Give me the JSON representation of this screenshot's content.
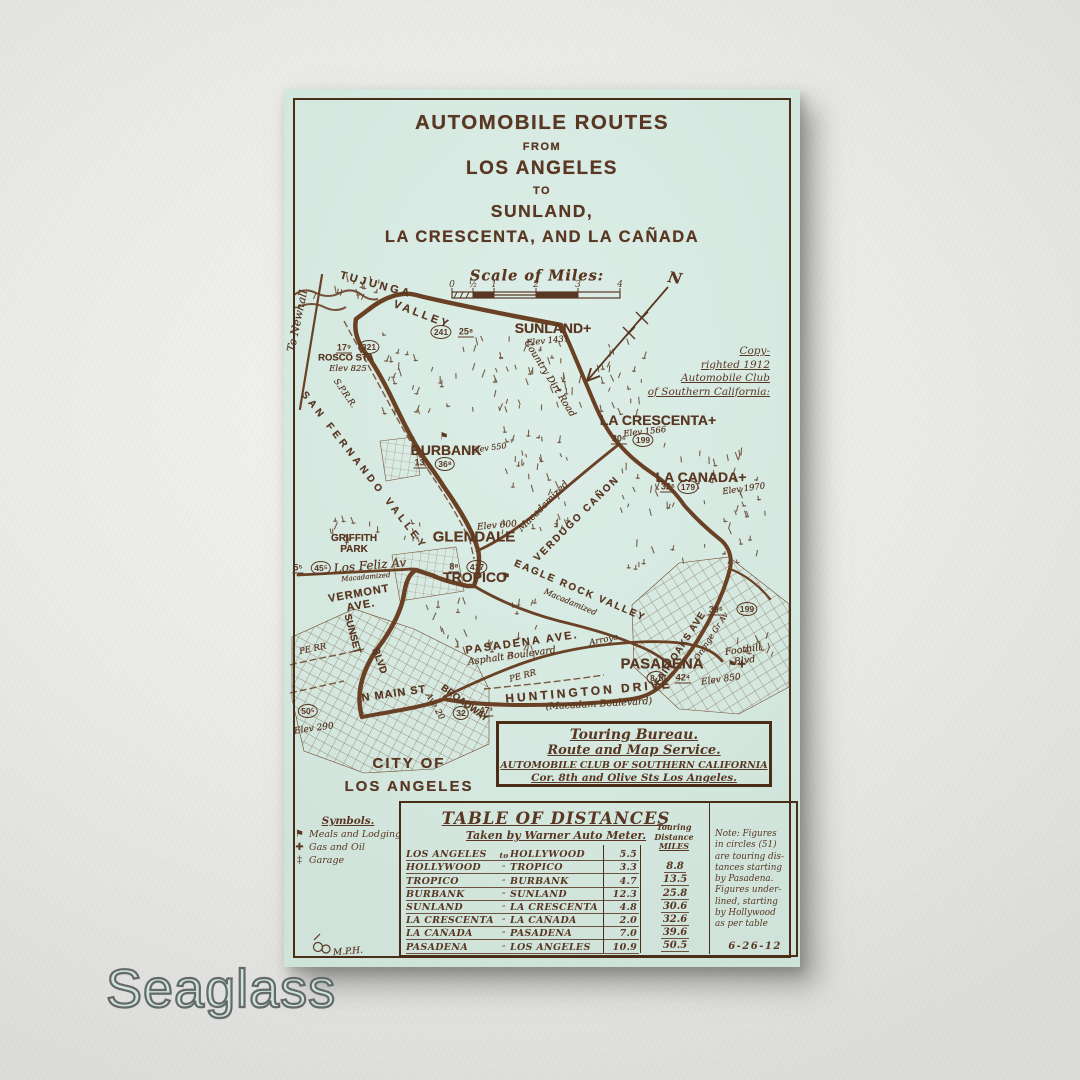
{
  "watermark": {
    "text": "Seaglass"
  },
  "colors": {
    "wall": "#e9e9e7",
    "panel": "#d6eae2",
    "ink": "#593722",
    "frame": "#4a2d17",
    "watermark_fill": "#cfe4dc"
  },
  "map": {
    "title": {
      "lines": [
        "AUTOMOBILE ROUTES",
        "FROM",
        "LOS ANGELES",
        "TO",
        "SUNLAND,",
        "LA CRESCENTA, AND LA CAÑADA"
      ]
    },
    "scale": {
      "label": "Scale of Miles:",
      "ticks": [
        "0",
        "½",
        "1",
        "2",
        "3",
        "4"
      ]
    },
    "north": {
      "label": "N"
    },
    "copyright": {
      "lines": [
        "Copy-",
        "righted 1912",
        "Automobile Club",
        "of Southern California:"
      ]
    },
    "labels": [
      {
        "n": "to-newhall",
        "t": "To Newhall",
        "x": 14,
        "y": 232,
        "r": -78,
        "c": "script",
        "fs": 11
      },
      {
        "n": "tujunga",
        "t": "TUJUNGA",
        "x": 92,
        "y": 196,
        "r": 15,
        "c": "stencil",
        "fs": 11,
        "ls": 3
      },
      {
        "n": "tujunga-valley",
        "t": "VALLEY",
        "x": 138,
        "y": 226,
        "r": 21,
        "c": "stencil",
        "fs": 11,
        "ls": 3
      },
      {
        "n": "rosco-sta",
        "t": "ROSCO STA",
        "x": 62,
        "y": 270,
        "r": 0,
        "c": "stencil",
        "fs": 9.5
      },
      {
        "n": "rosco-elev",
        "t": "Elev 825",
        "x": 64,
        "y": 281,
        "r": 0,
        "c": "script",
        "fs": 8.5
      },
      {
        "n": "sunland",
        "t": "SUNLAND+",
        "x": 269,
        "y": 240,
        "r": 0,
        "c": "stencil",
        "fs": 14
      },
      {
        "n": "sunland-elev",
        "t": "Elev 1431",
        "x": 264,
        "y": 253,
        "r": -6,
        "c": "script",
        "fs": 8.5
      },
      {
        "n": "country-dirt-road",
        "t": "Country Dirt Road",
        "x": 265,
        "y": 290,
        "r": 58,
        "c": "script",
        "fs": 9.5
      },
      {
        "n": "la-crescenta",
        "t": "LA CRESCENTA+",
        "x": 374,
        "y": 332,
        "r": 0,
        "c": "stencil",
        "fs": 14
      },
      {
        "n": "la-crescenta-elev",
        "t": "Elev 1566",
        "x": 361,
        "y": 344,
        "r": -6,
        "c": "script",
        "fs": 8.5
      },
      {
        "n": "la-canada",
        "t": "LA CANADA+",
        "x": 417,
        "y": 389,
        "r": 0,
        "c": "stencil",
        "fs": 14
      },
      {
        "n": "la-canada-elev",
        "t": "Elev 1970",
        "x": 460,
        "y": 401,
        "r": -8,
        "c": "script",
        "fs": 8.5
      },
      {
        "n": "sprr",
        "t": "S.P.R.R.",
        "x": 60,
        "y": 305,
        "r": 55,
        "c": "script",
        "fs": 8.5
      },
      {
        "n": "san-fernando-valley",
        "t": "SAN FERNANDO VALLEY",
        "x": 80,
        "y": 382,
        "r": 52,
        "c": "stencil",
        "fs": 10,
        "ls": 4
      },
      {
        "n": "burbank",
        "t": "BURBANK",
        "x": 162,
        "y": 362,
        "r": 0,
        "c": "stencil",
        "fs": 14
      },
      {
        "n": "burbank-elev",
        "t": "Elev 550",
        "x": 205,
        "y": 360,
        "r": -8,
        "c": "script",
        "fs": 8
      },
      {
        "n": "glendale-elev",
        "t": "Elev 600",
        "x": 213,
        "y": 437,
        "r": -5,
        "c": "script",
        "fs": 9
      },
      {
        "n": "glendale",
        "t": "GLENDALE",
        "x": 190,
        "y": 449,
        "r": 0,
        "c": "stencil",
        "fs": 15
      },
      {
        "n": "macadamized-verdugo",
        "t": "Macadamized",
        "x": 260,
        "y": 418,
        "r": -45,
        "c": "script",
        "fs": 9.5
      },
      {
        "n": "verdugo-canon",
        "t": "VERDUGO CAÑON",
        "x": 293,
        "y": 430,
        "r": -45,
        "c": "stencil",
        "fs": 10,
        "ls": 2
      },
      {
        "n": "griffith-park",
        "t": "GRIFFITH\nPARK",
        "x": 70,
        "y": 455,
        "r": 0,
        "c": "stencil",
        "fs": 10
      },
      {
        "n": "los-feliz-av",
        "t": "Los Feliz Av",
        "x": 86,
        "y": 477,
        "r": -5,
        "c": "script",
        "fs": 12
      },
      {
        "n": "macadamized-losfeliz",
        "t": "Macadamized",
        "x": 82,
        "y": 489,
        "r": -5,
        "c": "script",
        "fs": 7
      },
      {
        "n": "vermont-ave",
        "t": "VERMONT\nAVE.",
        "x": 76,
        "y": 511,
        "r": -10,
        "c": "stencil",
        "fs": 11,
        "ls": 1
      },
      {
        "n": "tropico",
        "t": "TROPICO",
        "x": 191,
        "y": 489,
        "r": 0,
        "c": "stencil",
        "fs": 14
      },
      {
        "n": "sunset",
        "t": "SUNSET",
        "x": 68,
        "y": 545,
        "r": 75,
        "c": "stencil",
        "fs": 10
      },
      {
        "n": "sunset-blvd",
        "t": "BLVD",
        "x": 95,
        "y": 572,
        "r": 70,
        "c": "stencil",
        "fs": 10
      },
      {
        "n": "pe-rr-west",
        "t": "PE RR",
        "x": 29,
        "y": 561,
        "r": -12,
        "c": "script",
        "fs": 8.5
      },
      {
        "n": "eagle-rock-valley",
        "t": "EAGLE ROCK VALLEY",
        "x": 296,
        "y": 502,
        "r": 23,
        "c": "stencil",
        "fs": 10,
        "ls": 2
      },
      {
        "n": "macadamized-eagle",
        "t": "Macadamized",
        "x": 286,
        "y": 514,
        "r": 23,
        "c": "script",
        "fs": 8
      },
      {
        "n": "pasadena-ave",
        "t": "PASADENA AVE.",
        "x": 238,
        "y": 554,
        "r": -8,
        "c": "stencil",
        "fs": 11,
        "ls": 2
      },
      {
        "n": "asphalt-boulevard",
        "t": "Asphalt Boulevard",
        "x": 228,
        "y": 568,
        "r": -8,
        "c": "script",
        "fs": 9.5
      },
      {
        "n": "arroyo",
        "t": "Arroyo",
        "x": 320,
        "y": 552,
        "r": -12,
        "c": "script",
        "fs": 8.5
      },
      {
        "n": "pe-rr-east",
        "t": "PE RR",
        "x": 239,
        "y": 588,
        "r": -15,
        "c": "script",
        "fs": 8.5
      },
      {
        "n": "fair-oaks-ave",
        "t": "FAIR OAKS AVE",
        "x": 397,
        "y": 560,
        "r": -57,
        "c": "stencil",
        "fs": 9.5,
        "ls": 1
      },
      {
        "n": "orange-grove-av",
        "t": "Orange Gr Av",
        "x": 428,
        "y": 548,
        "r": -57,
        "c": "script",
        "fs": 8
      },
      {
        "n": "foothill-blvd",
        "t": "Foothill\nBlvd",
        "x": 460,
        "y": 567,
        "r": -8,
        "c": "script",
        "fs": 9.5
      },
      {
        "n": "pasadena",
        "t": "PASADENA",
        "x": 378,
        "y": 576,
        "r": 0,
        "c": "stencil",
        "fs": 15
      },
      {
        "n": "pasadena-elev",
        "t": "Elev 850",
        "x": 437,
        "y": 591,
        "r": -8,
        "c": "script",
        "fs": 9
      },
      {
        "n": "huntington-drive",
        "t": "HUNTINGTON DRIVE",
        "x": 305,
        "y": 603,
        "r": -5,
        "c": "stencil",
        "fs": 12,
        "ls": 3
      },
      {
        "n": "macadam-boulevard",
        "t": "(Macadam Boulevard)",
        "x": 315,
        "y": 616,
        "r": -3,
        "c": "script",
        "fs": 9.5
      },
      {
        "n": "n-main-st",
        "t": "N MAIN ST",
        "x": 110,
        "y": 605,
        "r": -8,
        "c": "stencil",
        "fs": 11,
        "ls": 1
      },
      {
        "n": "broadway",
        "t": "BROADWAY",
        "x": 180,
        "y": 615,
        "r": 36,
        "c": "stencil",
        "fs": 9.5
      },
      {
        "n": "ave-20",
        "t": "Ave 20",
        "x": 150,
        "y": 618,
        "r": 60,
        "c": "script",
        "fs": 8.5
      },
      {
        "n": "la-elev",
        "t": "Elev 290",
        "x": 30,
        "y": 640,
        "r": -8,
        "c": "script",
        "fs": 9
      },
      {
        "n": "city-of-los-angeles",
        "t": "CITY OF\nLOS ANGELES",
        "x": 125,
        "y": 686,
        "r": 0,
        "c": "stencil",
        "fs": 15,
        "ls": 2,
        "lh": 1.55
      },
      {
        "n": "mph-initials",
        "t": "M.P.H.",
        "x": 64,
        "y": 863,
        "r": -5,
        "c": "script",
        "fs": 9
      }
    ],
    "badges": [
      {
        "k": "u",
        "t": "17⁹",
        "x": 60,
        "y": 259
      },
      {
        "k": "c",
        "t": "321",
        "x": 85,
        "y": 258
      },
      {
        "k": "c",
        "t": "241",
        "x": 157,
        "y": 243
      },
      {
        "k": "u",
        "t": "25⁸",
        "x": 182,
        "y": 243
      },
      {
        "k": "u",
        "t": "30⁶",
        "x": 335,
        "y": 350
      },
      {
        "k": "c",
        "t": "199",
        "x": 359,
        "y": 351
      },
      {
        "k": "u",
        "t": "32⁶",
        "x": 384,
        "y": 398
      },
      {
        "k": "c",
        "t": "179",
        "x": 404,
        "y": 398
      },
      {
        "k": "u",
        "t": "13²",
        "x": 137,
        "y": 374
      },
      {
        "k": "c",
        "t": "36⁸",
        "x": 161,
        "y": 375
      },
      {
        "k": "u",
        "t": "8⁸",
        "x": 170,
        "y": 478
      },
      {
        "k": "c",
        "t": "417",
        "x": 193,
        "y": 478
      },
      {
        "k": "u",
        "t": "5⁵",
        "x": 14,
        "y": 479
      },
      {
        "k": "c",
        "t": "45⁵",
        "x": 37,
        "y": 479
      },
      {
        "k": "u",
        "t": "39⁶",
        "x": 432,
        "y": 521
      },
      {
        "k": "c",
        "t": "199",
        "x": 463,
        "y": 520
      },
      {
        "k": "c",
        "t": "8.1",
        "x": 372,
        "y": 589
      },
      {
        "k": "u",
        "t": "42⁴",
        "x": 399,
        "y": 589
      },
      {
        "k": "c",
        "t": "50⁵",
        "x": 24,
        "y": 622
      },
      {
        "k": "c",
        "t": "32",
        "x": 177,
        "y": 624
      },
      {
        "k": "u",
        "t": "47³",
        "x": 202,
        "y": 622
      }
    ],
    "icons": [
      {
        "type": "flag",
        "x": 160,
        "y": 348
      },
      {
        "type": "flag",
        "x": 222,
        "y": 488
      },
      {
        "type": "flag",
        "x": 448,
        "y": 576
      },
      {
        "type": "gas-cross",
        "x": 458,
        "y": 576
      }
    ],
    "symbols": {
      "title": "Symbols.",
      "items": [
        {
          "icon": "flag",
          "label": "Meals and Lodging"
        },
        {
          "icon": "gas-cross",
          "label": "Gas and Oil"
        },
        {
          "icon": "garage-cross",
          "label": "Garage"
        }
      ]
    },
    "touring_bureau": {
      "lines": [
        "Touring Bureau.",
        "Route and Map Service.",
        "AUTOMOBILE CLUB OF SOUTHERN CALIFORNIA",
        "Cor. 8th and Olive Sts Los Angeles."
      ]
    },
    "distance_table": {
      "title": "TABLE OF DISTANCES",
      "subtitle": "Taken by Warner Auto Meter.",
      "touring_header": [
        "Touring",
        "Distance",
        "MILES"
      ],
      "rows": [
        {
          "from": "LOS ANGELES",
          "sep": "to",
          "to": "HOLLYWOOD",
          "miles": "5.5",
          "touring": ""
        },
        {
          "from": "HOLLYWOOD",
          "sep": "″",
          "to": "TROPICO",
          "miles": "3.3",
          "touring": "8.8"
        },
        {
          "from": "TROPICO",
          "sep": "″",
          "to": "BURBANK",
          "miles": "4.7",
          "touring": "13.5"
        },
        {
          "from": "BURBANK",
          "sep": "″",
          "to": "SUNLAND",
          "miles": "12.3",
          "touring": "25.8"
        },
        {
          "from": "SUNLAND",
          "sep": "″",
          "to": "LA CRESCENTA",
          "miles": "4.8",
          "touring": "30.6"
        },
        {
          "from": "LA CRESCENTA",
          "sep": "″",
          "to": "LA CAÑADA",
          "miles": "2.0",
          "touring": "32.6"
        },
        {
          "from": "LA CAÑADA",
          "sep": "″",
          "to": "PASADENA",
          "miles": "7.0",
          "touring": "39.6"
        },
        {
          "from": "PASADENA",
          "sep": "″",
          "to": "LOS ANGELES",
          "miles": "10.9",
          "touring": "50.5"
        }
      ]
    },
    "note": {
      "lines": [
        "Note: Figures",
        "in circles (51)",
        "are touring dis-",
        "tances starting",
        "by Pasadena.",
        "Figures under-",
        "lined, starting",
        "by Hollywood",
        "as per table"
      ],
      "date": "6-26-12"
    },
    "initials": "M.P.H."
  }
}
